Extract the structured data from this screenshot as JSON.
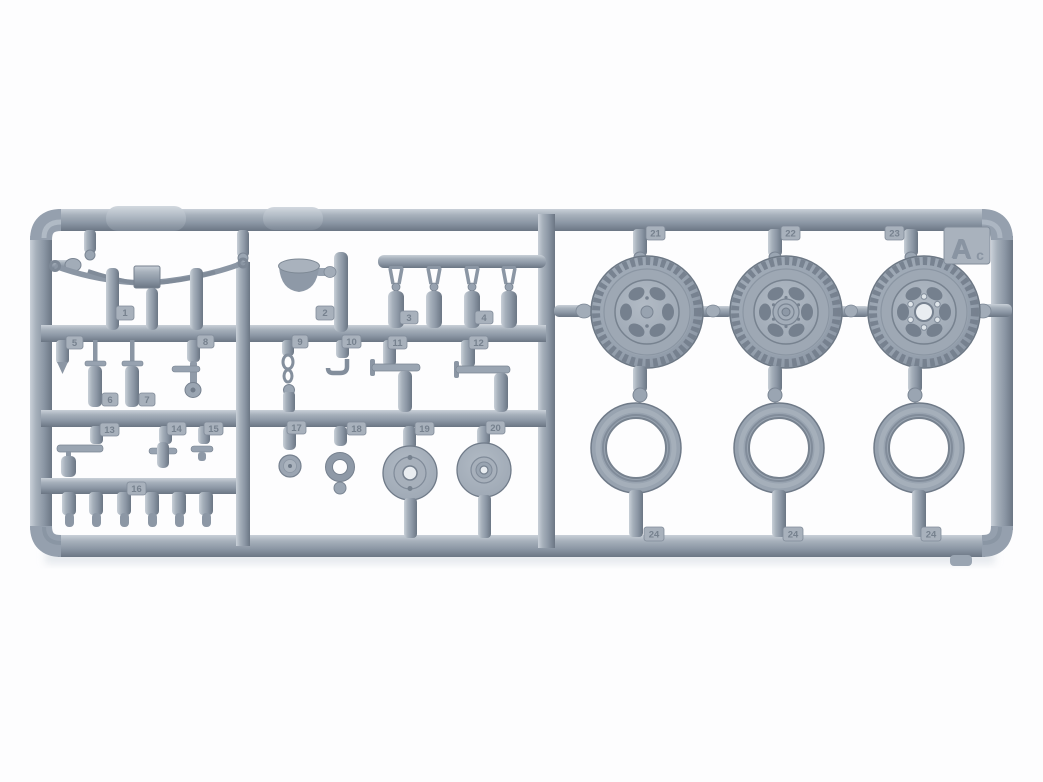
{
  "corner_plate": {
    "letter": "A",
    "sub": "c"
  },
  "tags": {
    "p1": "1",
    "p2": "2",
    "p3": "3",
    "p4": "4",
    "p5": "5",
    "p6": "6",
    "p7": "7",
    "p8": "8",
    "p9": "9",
    "p10": "10",
    "p11": "11",
    "p12": "12",
    "p13": "13",
    "p14": "14",
    "p15": "15",
    "p16": "16",
    "p17": "17",
    "p18": "18",
    "p19": "19",
    "p20": "20",
    "p21": "21",
    "p22": "22",
    "p23": "23",
    "p24a": "24",
    "p24b": "24",
    "p24c": "24"
  },
  "colors": {
    "plastic_mid": "#96a1af",
    "plastic_light": "#c9d0d8",
    "plastic_dark": "#6b7684",
    "tag_plate": "#a8b1bc",
    "background": "#fdfdfe"
  }
}
